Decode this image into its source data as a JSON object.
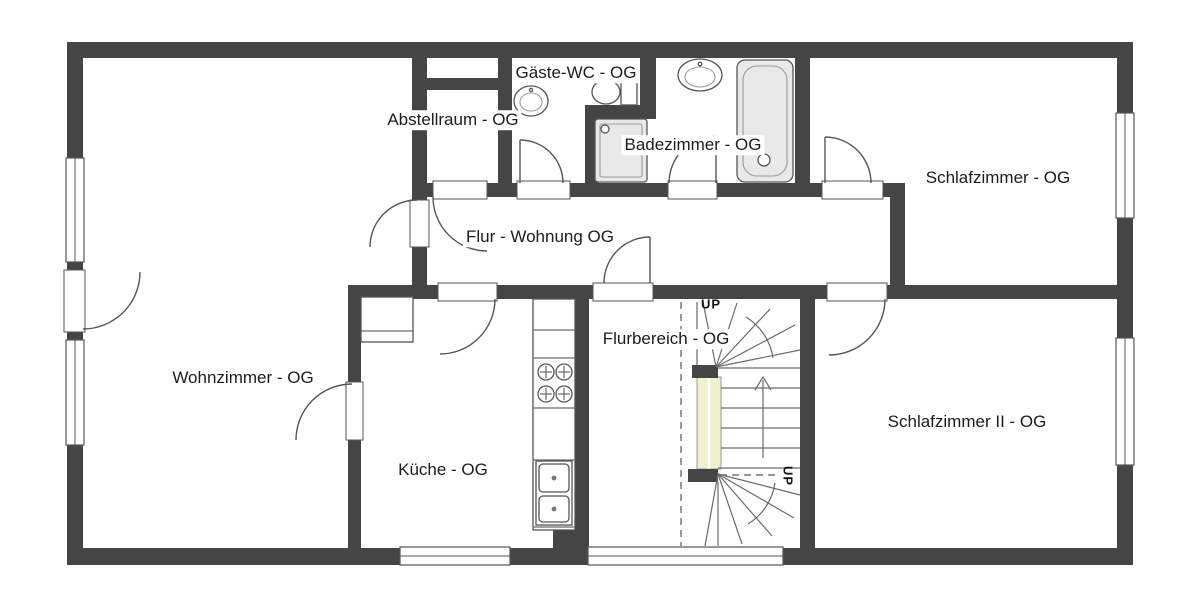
{
  "plan_type": "floor-plan-upper-storey",
  "rooms": [
    {
      "id": "gaeste-wc",
      "label": "Gäste-WC - OG"
    },
    {
      "id": "abstellraum",
      "label": "Abstellraum - OG"
    },
    {
      "id": "badezimmer",
      "label": "Badezimmer - OG"
    },
    {
      "id": "schlafzimmer",
      "label": "Schlafzimmer - OG"
    },
    {
      "id": "flur",
      "label": "Flur - Wohnung OG"
    },
    {
      "id": "flurbereich",
      "label": "Flurbereich - OG"
    },
    {
      "id": "wohnzimmer",
      "label": "Wohnzimmer - OG"
    },
    {
      "id": "schlafzimmer2",
      "label": "Schlafzimmer II - OG"
    },
    {
      "id": "kueche",
      "label": "Küche - OG"
    }
  ],
  "stairs": {
    "up_top": "UP",
    "up_bottom": "UP"
  },
  "fixtures": [
    {
      "name": "toilet",
      "room": "Gäste-WC - OG"
    },
    {
      "name": "washbasin",
      "room": "Gäste-WC - OG"
    },
    {
      "name": "washbasin",
      "room": "Badezimmer - OG"
    },
    {
      "name": "bathtub",
      "room": "Badezimmer - OG"
    },
    {
      "name": "shower",
      "room": "Badezimmer - OG"
    },
    {
      "name": "kitchen-counter-stove-double-sink",
      "room": "Küche - OG"
    },
    {
      "name": "cabinet",
      "room": "Küche - OG"
    },
    {
      "name": "winder-staircase",
      "room": "Flurbereich - OG"
    }
  ],
  "counts": {
    "windows": 6,
    "doors": 10
  },
  "colors": {
    "wall": "#454545",
    "line": "#555555",
    "fixture_fill": "#e9e9e9",
    "stair_rail": "#eff0cd",
    "background": "#ffffff",
    "text": "#1c1c1c"
  }
}
